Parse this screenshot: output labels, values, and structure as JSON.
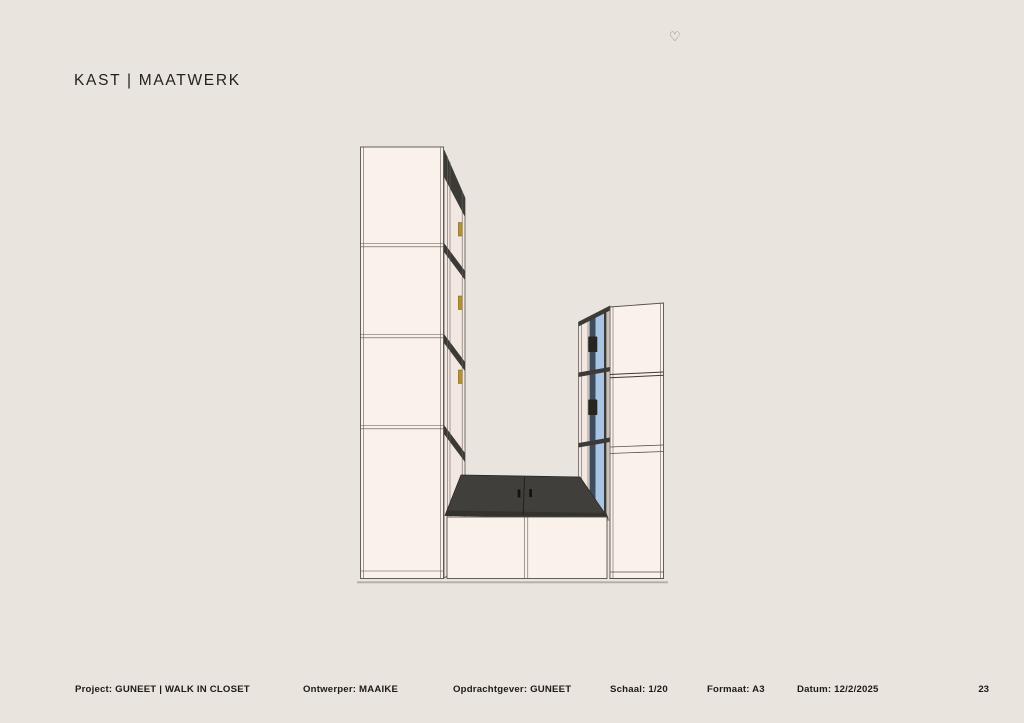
{
  "page": {
    "title": "KAST | MAATWERK",
    "heart_icon": "♡",
    "page_number": "23",
    "background_color": "#e9e4dd"
  },
  "footer": {
    "items": [
      {
        "text": "Project: GUNEET | WALK IN CLOSET"
      },
      {
        "text": "Ontwerper: MAAIKE"
      },
      {
        "text": "Opdrachtgever: GUNEET"
      },
      {
        "text": "Schaal: 1/20"
      },
      {
        "text": "Formaat: A3"
      },
      {
        "text": "Datum: 12/2/2025"
      }
    ]
  },
  "drawing": {
    "subject": "Perspective drawing of a custom walk-in closet: tall left wardrobe with four door sections, corner bench with dark seat top and two push-open doors, right wardrobe with three sections and blue interior side panels with dark hinges",
    "colors": {
      "front_panel": "#faf1eb",
      "side_panel": "#f3e8e1",
      "interior_dark": "#3b3a36",
      "bench_top": "#403f3b",
      "bench_edge": "#33322e",
      "accent_blue": "#a8c5e6",
      "accent_navy": "#3f4c5e",
      "hinge_gold": "#b3922f",
      "outline": "#56514a",
      "floor_line": "#b3ada4"
    }
  }
}
